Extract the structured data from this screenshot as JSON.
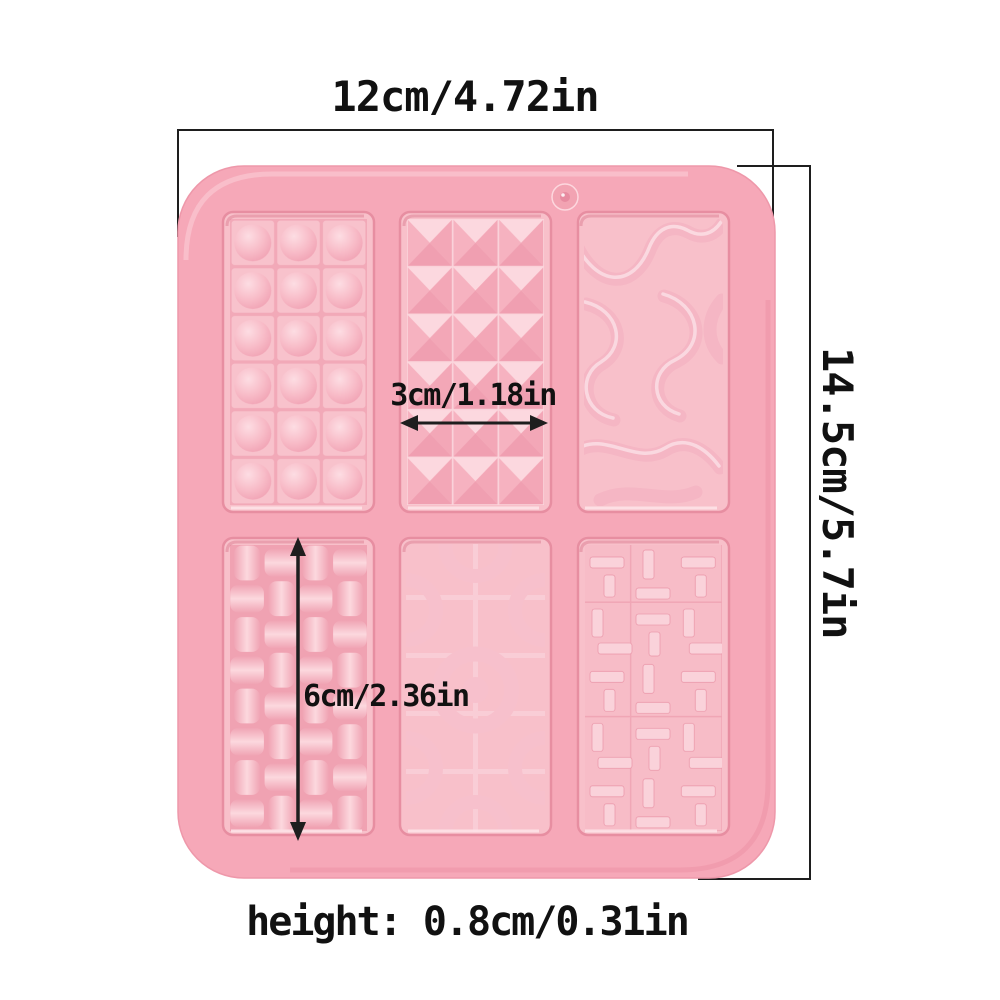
{
  "labels": {
    "mold_width": "12cm/4.72in",
    "mold_height": "14.5cm/5.7in",
    "cavity_width": "3cm/1.18in",
    "cavity_height": "6cm/2.36in",
    "mold_thickness": "height: 0.8cm/0.31in"
  },
  "colors": {
    "background": "#ffffff",
    "mold_body": "#f6a8b8",
    "mold_edge": "#ee98aa",
    "cavity_floor": "#f8c0ca",
    "pattern_raised": "#f9cdd5",
    "pattern_highlight": "#fcd8de",
    "pattern_shadow": "#f0a2b2",
    "dimension_line": "#1e1e1e",
    "label_text": "#111111"
  },
  "mold": {
    "type": "silicone-chocolate-bar-mold",
    "cavity_count": 6,
    "hanging_hole": true,
    "cavities": [
      {
        "position": "top-left",
        "pattern": "dome-bubbles-grid",
        "cells": "3x6"
      },
      {
        "position": "top-center",
        "pattern": "pyramid-facets-grid",
        "cells": "3x6"
      },
      {
        "position": "top-right",
        "pattern": "organic-wavy-ribbons",
        "cells": ""
      },
      {
        "position": "bottom-left",
        "pattern": "basket-weave",
        "cells": "4x8"
      },
      {
        "position": "bottom-center",
        "pattern": "concentric-rings-grid",
        "cells": "2x5"
      },
      {
        "position": "bottom-right",
        "pattern": "geometric-maze-bars",
        "cells": "3x5"
      }
    ]
  }
}
